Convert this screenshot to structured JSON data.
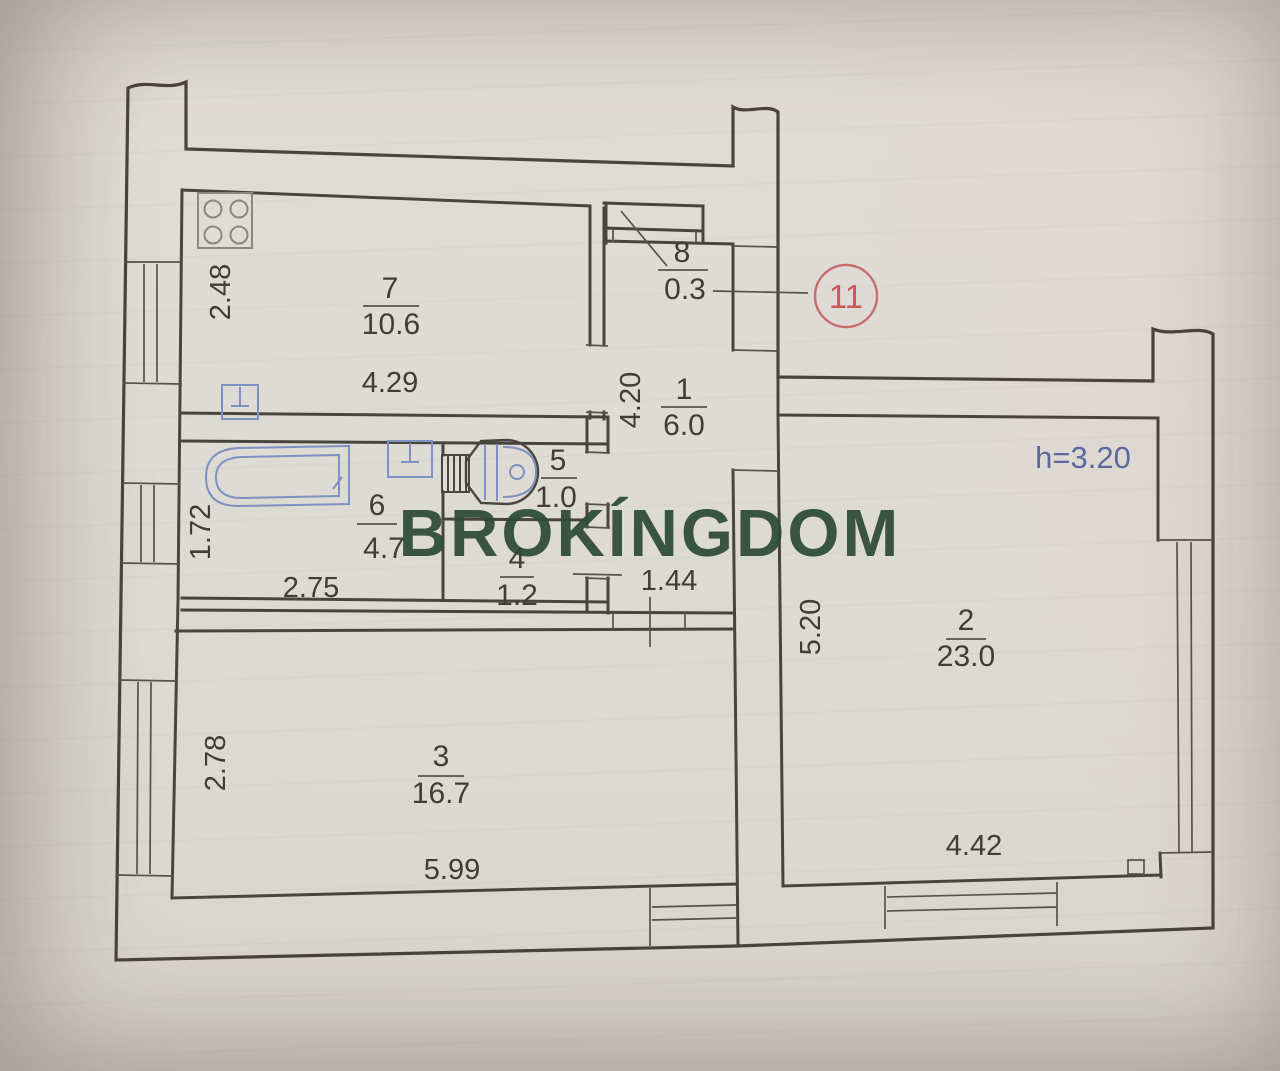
{
  "document": {
    "type": "apartment floor plan photo"
  },
  "watermark": {
    "text": "BROKÍNGDOM",
    "color": "#2d4a3b"
  },
  "unit_badge": {
    "number": "11",
    "color": "#c8585a"
  },
  "height_note": {
    "text": "h=3.20",
    "color": "#5a6a9d"
  },
  "rooms": [
    {
      "number": "7",
      "area": "10.6"
    },
    {
      "number": "8",
      "area": "0.3"
    },
    {
      "number": "1",
      "area": "6.0"
    },
    {
      "number": "5",
      "area": "1.0"
    },
    {
      "number": "6",
      "area": "4.7"
    },
    {
      "number": "4",
      "area": "1.2"
    },
    {
      "number": "3",
      "area": "16.7"
    },
    {
      "number": "2",
      "area": "23.0"
    }
  ],
  "dimensions": [
    {
      "value": "2.48"
    },
    {
      "value": "4.29"
    },
    {
      "value": "4.20"
    },
    {
      "value": "1.72"
    },
    {
      "value": "2.75"
    },
    {
      "value": "1.44"
    },
    {
      "value": "2.78"
    },
    {
      "value": "5.99"
    },
    {
      "value": "5.20"
    },
    {
      "value": "4.42"
    }
  ],
  "fixtures": [
    "stove-icon",
    "kitchen-sink-icon",
    "bathtub-icon",
    "bath-sink-icon",
    "toilet-icon"
  ],
  "colors": {
    "wall": "#4a443e",
    "fixture_blue": "#7e92c1",
    "paper": "#ddd9d4"
  }
}
